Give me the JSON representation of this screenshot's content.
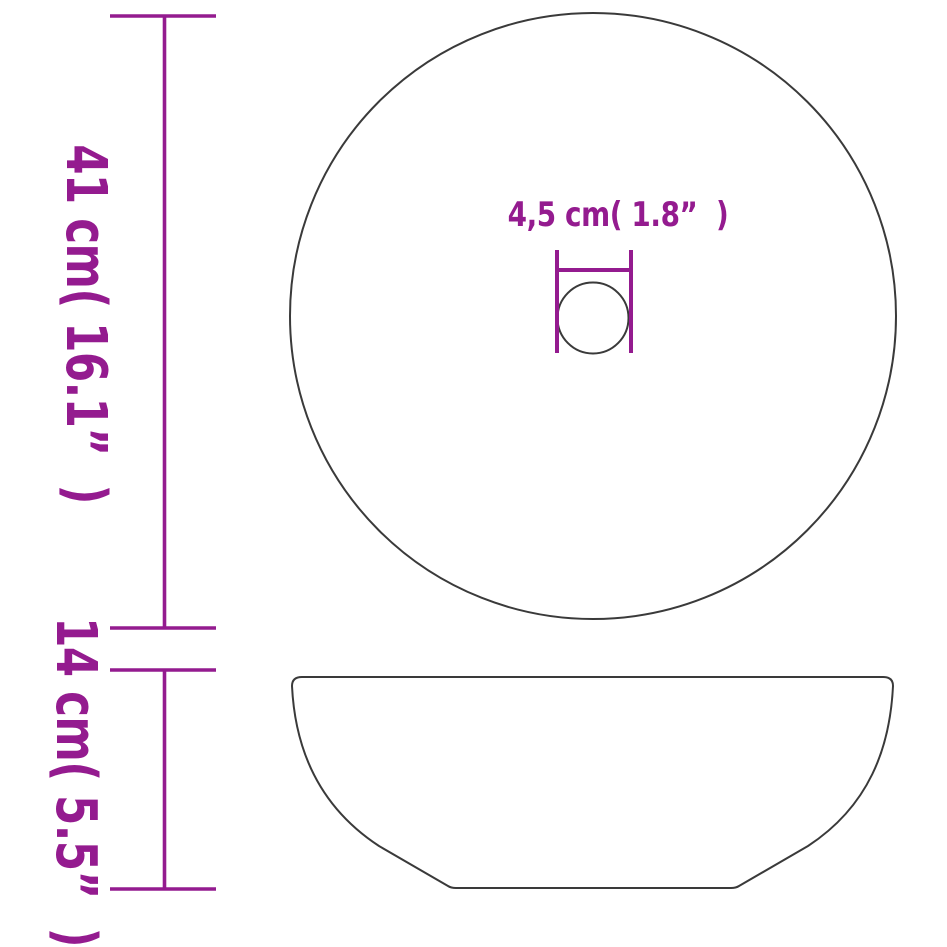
{
  "diagram": {
    "kind": "product-dimension-diagram",
    "views": [
      "top-view",
      "side-view"
    ]
  },
  "labels": {
    "overall_diameter": "41 cm( 16.1”  )",
    "height": "14 cm( 5.5”  )",
    "drain_diameter": "4,5 cm( 1.8”  )"
  },
  "colors": {
    "dimension_accent": "#941b8f",
    "outline": "#3a3a3a",
    "background": "#ffffff"
  }
}
